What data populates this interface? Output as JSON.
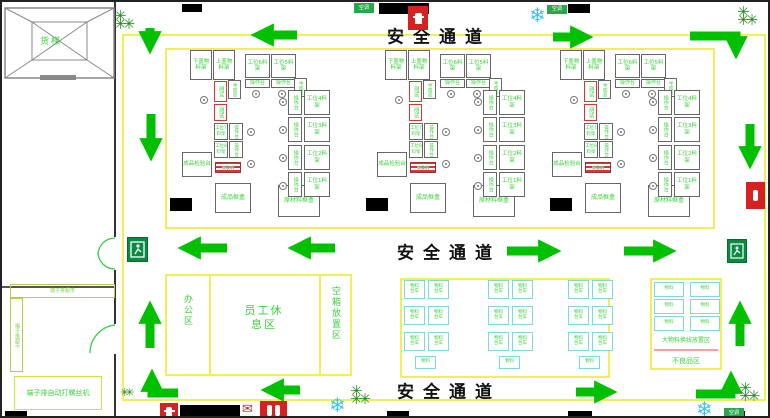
{
  "corridor_label": "安全通道",
  "elevator_label": "货梯",
  "ac_sign_label": "空调",
  "left_room": {
    "shelf_top_label": "端子排超市",
    "shelf_left_label": "端子排超市",
    "machine_label": "端子排自动打螺丝机"
  },
  "office_area": {
    "office_label": "办公区",
    "rest_label": "员工休息区",
    "empty_box_label": "空箱放置区"
  },
  "cluster": {
    "rack_a": "下盖物料架",
    "rack_b": "上盖物料架",
    "ws6": "工位6料架",
    "ws5": "工位5料架",
    "ws4": "工位4料架",
    "ws3": "工位3料架",
    "ws2": "工位2料架",
    "ws1": "工位1料架",
    "ws7": "工位7料架",
    "ws8": "工位8料架",
    "op": "操作台",
    "red_station": "测试",
    "side_rack": "半成品",
    "inspect": "成品检验台",
    "striped": "点胶机",
    "finished": "成品框盒",
    "raw": "原材料框盒"
  },
  "storage": {
    "cart_line1": "物料",
    "cart_line2": "台车",
    "big_material_label": "大物料换线放置区",
    "defective_label": "不良品区"
  },
  "icons": {
    "fire_hydrant": "fire-hydrant-sign",
    "fire_extinguisher": "fire-extinguisher",
    "exit": "emergency-exit-sign",
    "fan": "snowflake-fan",
    "plant": "plant"
  },
  "colors": {
    "arrow_green": "#00c000",
    "label_green": "#3ad23a",
    "line_yellow": "#f3ee56",
    "alert_red": "#d42222",
    "cart_cyan": "#7adadd",
    "exit_green": "#0a8a40",
    "snow_blue": "#3ec3f0"
  },
  "layout_counts": {
    "clusters": 3,
    "cart_groups": 3,
    "carts_per_group": 7,
    "right_area_carts": 6
  }
}
